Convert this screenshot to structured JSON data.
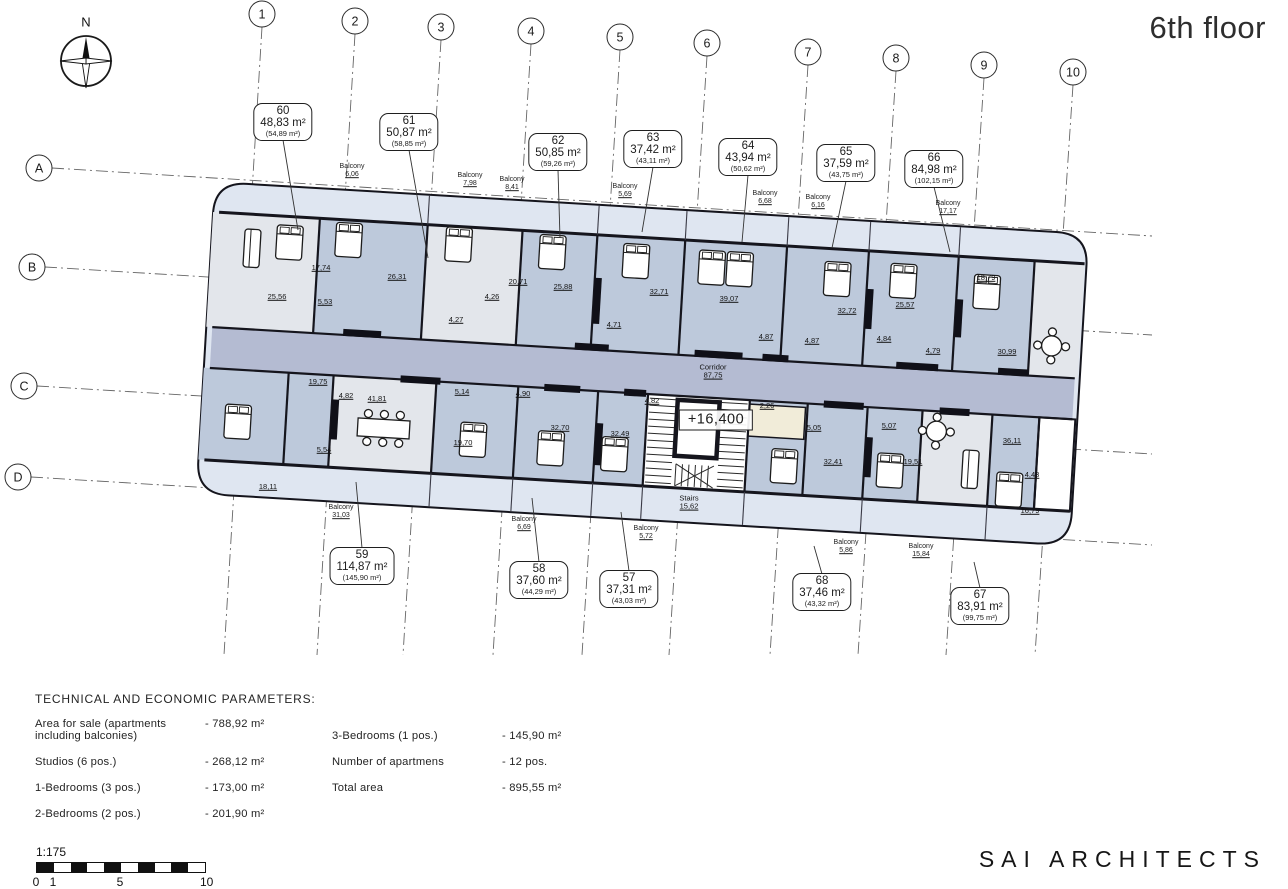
{
  "title": "6th floor",
  "logo": "SAI ARCHITECTS",
  "compass": {
    "label": "N"
  },
  "elevation_mark": "+16,400",
  "corridor": {
    "label": "Corridor",
    "area": "87,75",
    "x": 713,
    "y": 372
  },
  "stairs": {
    "label": "Stairs",
    "area": "15,62",
    "x": 689,
    "y": 503
  },
  "colors": {
    "room_blue": "#bdc9db",
    "room_gray": "#e3e6eb",
    "balcony": "#dfe6f1",
    "corridor": "#b4bbd2",
    "wall": "#15151d",
    "beige": "#f1ecd9",
    "white": "#ffffff"
  },
  "grid": {
    "columns": [
      {
        "label": "1",
        "x": 262,
        "y": 14
      },
      {
        "label": "2",
        "x": 355,
        "y": 21
      },
      {
        "label": "3",
        "x": 441,
        "y": 27
      },
      {
        "label": "4",
        "x": 531,
        "y": 31
      },
      {
        "label": "5",
        "x": 620,
        "y": 37
      },
      {
        "label": "6",
        "x": 707,
        "y": 43
      },
      {
        "label": "7",
        "x": 808,
        "y": 52
      },
      {
        "label": "8",
        "x": 896,
        "y": 58
      },
      {
        "label": "9",
        "x": 984,
        "y": 65
      },
      {
        "label": "10",
        "x": 1073,
        "y": 72
      }
    ],
    "rows": [
      {
        "label": "A",
        "x": 39,
        "y": 168
      },
      {
        "label": "B",
        "x": 32,
        "y": 267
      },
      {
        "label": "C",
        "x": 24,
        "y": 386
      },
      {
        "label": "D",
        "x": 18,
        "y": 477
      }
    ]
  },
  "apartments": [
    {
      "no": "60",
      "area": "48,83 m²",
      "total": "(54,89 m²)",
      "x": 283,
      "y": 122,
      "side": "top",
      "tx": 298,
      "ty": 230
    },
    {
      "no": "61",
      "area": "50,87 m²",
      "total": "(58,85 m²)",
      "x": 409,
      "y": 132,
      "side": "top",
      "tx": 428,
      "ty": 258
    },
    {
      "no": "62",
      "area": "50,85 m²",
      "total": "(59,26 m²)",
      "x": 558,
      "y": 152,
      "side": "top",
      "tx": 560,
      "ty": 238
    },
    {
      "no": "63",
      "area": "37,42 m²",
      "total": "(43,11 m²)",
      "x": 653,
      "y": 149,
      "side": "top",
      "tx": 642,
      "ty": 232
    },
    {
      "no": "64",
      "area": "43,94 m²",
      "total": "(50,62 m²)",
      "x": 748,
      "y": 157,
      "side": "top",
      "tx": 742,
      "ty": 242
    },
    {
      "no": "65",
      "area": "37,59 m²",
      "total": "(43,75 m²)",
      "x": 846,
      "y": 163,
      "side": "top",
      "tx": 832,
      "ty": 248
    },
    {
      "no": "66",
      "area": "84,98 m²",
      "total": "(102,15 m²)",
      "x": 934,
      "y": 169,
      "side": "top",
      "tx": 950,
      "ty": 252
    },
    {
      "no": "59",
      "area": "114,87 m²",
      "total": "(145,90 m²)",
      "x": 362,
      "y": 566,
      "side": "bottom",
      "tx": 356,
      "ty": 482
    },
    {
      "no": "58",
      "area": "37,60 m²",
      "total": "(44,29 m²)",
      "x": 539,
      "y": 580,
      "side": "bottom",
      "tx": 532,
      "ty": 498
    },
    {
      "no": "57",
      "area": "37,31 m²",
      "total": "(43,03 m²)",
      "x": 629,
      "y": 589,
      "side": "bottom",
      "tx": 621,
      "ty": 512
    },
    {
      "no": "68",
      "area": "37,46 m²",
      "total": "(43,32 m²)",
      "x": 822,
      "y": 592,
      "side": "bottom",
      "tx": 814,
      "ty": 546
    },
    {
      "no": "67",
      "area": "83,91 m²",
      "total": "(99,75 m²)",
      "x": 980,
      "y": 606,
      "side": "bottom",
      "tx": 974,
      "ty": 562
    }
  ],
  "balconies": [
    {
      "label": "Balcony",
      "area": "6,06",
      "x": 352,
      "y": 171
    },
    {
      "label": "Balcony",
      "area": "7,98",
      "x": 470,
      "y": 180
    },
    {
      "label": "Balcony",
      "area": "8,41",
      "x": 512,
      "y": 184
    },
    {
      "label": "Balcony",
      "area": "5,69",
      "x": 625,
      "y": 191
    },
    {
      "label": "Balcony",
      "area": "6,68",
      "x": 765,
      "y": 198
    },
    {
      "label": "Balcony",
      "area": "6,16",
      "x": 818,
      "y": 202
    },
    {
      "label": "Balcony",
      "area": "17,17",
      "x": 948,
      "y": 208
    },
    {
      "label": "Balcony",
      "area": "31,03",
      "x": 341,
      "y": 512
    },
    {
      "label": "Balcony",
      "area": "6,69",
      "x": 524,
      "y": 524
    },
    {
      "label": "Balcony",
      "area": "5,72",
      "x": 646,
      "y": 533
    },
    {
      "label": "Balcony",
      "area": "5,86",
      "x": 846,
      "y": 547
    },
    {
      "label": "Balcony",
      "area": "15,84",
      "x": 921,
      "y": 551
    }
  ],
  "rooms": [
    {
      "t": "25,56",
      "x": 277,
      "y": 297
    },
    {
      "t": "17,74",
      "x": 321,
      "y": 268
    },
    {
      "t": "5,53",
      "x": 325,
      "y": 302
    },
    {
      "t": "26,31",
      "x": 397,
      "y": 277
    },
    {
      "t": "20,71",
      "x": 518,
      "y": 282
    },
    {
      "t": "4,27",
      "x": 456,
      "y": 320
    },
    {
      "t": "4,26",
      "x": 492,
      "y": 297
    },
    {
      "t": "25,88",
      "x": 563,
      "y": 287
    },
    {
      "t": "32,71",
      "x": 659,
      "y": 292
    },
    {
      "t": "4,71",
      "x": 614,
      "y": 325
    },
    {
      "t": "39,07",
      "x": 729,
      "y": 299
    },
    {
      "t": "4,87",
      "x": 766,
      "y": 337
    },
    {
      "t": "4,87",
      "x": 812,
      "y": 341
    },
    {
      "t": "32,72",
      "x": 847,
      "y": 311
    },
    {
      "t": "25,57",
      "x": 905,
      "y": 305
    },
    {
      "t": "4,84",
      "x": 884,
      "y": 339
    },
    {
      "t": "4,79",
      "x": 933,
      "y": 351
    },
    {
      "t": "18,79",
      "x": 986,
      "y": 278
    },
    {
      "t": "30,99",
      "x": 1007,
      "y": 352
    },
    {
      "t": "18,11",
      "x": 268,
      "y": 487
    },
    {
      "t": "19,75",
      "x": 318,
      "y": 382
    },
    {
      "t": "4,82",
      "x": 346,
      "y": 396
    },
    {
      "t": "41,81",
      "x": 377,
      "y": 399
    },
    {
      "t": "5,54",
      "x": 324,
      "y": 450
    },
    {
      "t": "5,14",
      "x": 462,
      "y": 392
    },
    {
      "t": "4,90",
      "x": 523,
      "y": 394
    },
    {
      "t": "19,70",
      "x": 463,
      "y": 443
    },
    {
      "t": "32,70",
      "x": 560,
      "y": 428
    },
    {
      "t": "32,49",
      "x": 620,
      "y": 434
    },
    {
      "t": "4,82",
      "x": 652,
      "y": 401
    },
    {
      "t": "2,26",
      "x": 767,
      "y": 406
    },
    {
      "t": "5,05",
      "x": 814,
      "y": 428
    },
    {
      "t": "32,41",
      "x": 833,
      "y": 462
    },
    {
      "t": "5,07",
      "x": 889,
      "y": 426
    },
    {
      "t": "19,51",
      "x": 913,
      "y": 462
    },
    {
      "t": "36,11",
      "x": 1012,
      "y": 441
    },
    {
      "t": "4,43",
      "x": 1032,
      "y": 475
    },
    {
      "t": "16,79",
      "x": 1030,
      "y": 511
    }
  ],
  "parameters": {
    "title": "TECHNICAL AND ECONOMIC PARAMETERS:",
    "left": [
      {
        "label": "Area for sale (apartments\nincluding balconies)",
        "value": "- 788,92 m²"
      },
      {
        "label": "Studios (6 pos.)",
        "value": "- 268,12 m²"
      },
      {
        "label": "1-Bedrooms (3 pos.)",
        "value": "- 173,00 m²"
      },
      {
        "label": "2-Bedrooms (2 pos.)",
        "value": "- 201,90 m²"
      }
    ],
    "right": [
      {
        "label": "3-Bedrooms (1 pos.)",
        "value": "- 145,90  m²"
      },
      {
        "label": "Number of apartmens",
        "value": "- 12 pos."
      },
      {
        "label": "Total area",
        "value": "- 895,55 m²"
      }
    ]
  },
  "scale_bar": {
    "ratio": "1:175",
    "ticks": [
      {
        "t": "0",
        "dx": 0
      },
      {
        "t": "1",
        "dx": 17
      },
      {
        "t": "5",
        "dx": 84
      },
      {
        "t": "10 m",
        "dx": 176
      }
    ]
  }
}
